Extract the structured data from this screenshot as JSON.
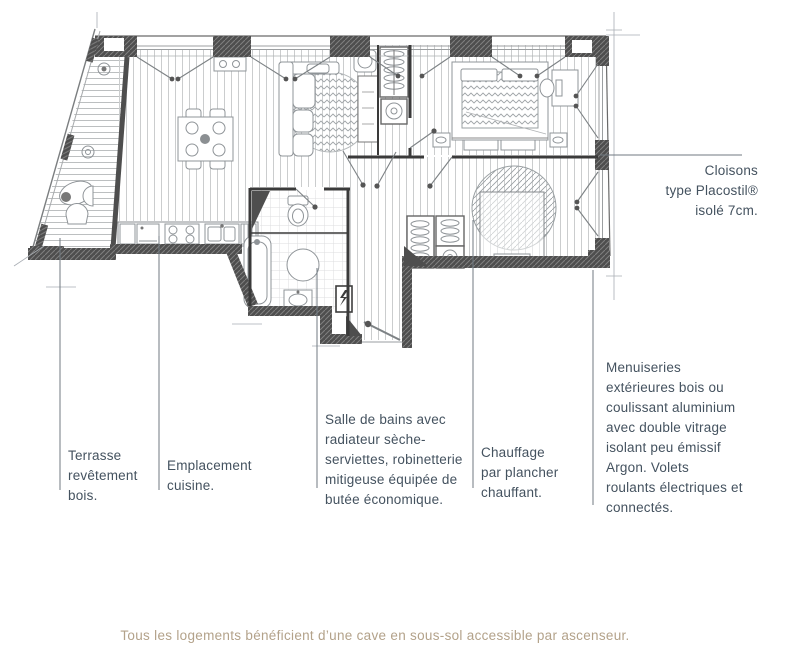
{
  "colors": {
    "annotation_text": "#44525f",
    "caption_text": "#b3a28a",
    "wall_dark": "#4e4e4e",
    "leader_line": "#707a82",
    "floor_line": "#c9cbcc"
  },
  "annotations": {
    "cloisons": {
      "lines": [
        "Cloisons",
        "type Placostil®",
        "isolé 7cm."
      ]
    },
    "menuiseries": {
      "lines": [
        "Menuiseries",
        "extérieures bois ou",
        "coulissant aluminium",
        "avec double vitrage",
        "isolant peu émissif",
        "Argon. Volets",
        "roulants électriques et",
        "connectés."
      ]
    },
    "terrasse": {
      "lines": [
        "Terrasse",
        "revêtement",
        "bois."
      ]
    },
    "cuisine": {
      "lines": [
        "Emplacement",
        "cuisine."
      ]
    },
    "salle_de_bains": {
      "lines": [
        "Salle de bains avec",
        "radiateur sèche-",
        "serviettes, robinetterie",
        "mitigeuse équipée de",
        "butée économique."
      ]
    },
    "chauffage": {
      "lines": [
        "Chauffage",
        "par plancher",
        "chauffant."
      ]
    }
  },
  "caption": {
    "text": "Tous les logements bénéficient d’une cave en sous-sol accessible par ascenseur."
  },
  "plan_symbols": [
    "terrace-deck",
    "terrace-chairs",
    "plant",
    "dining-table",
    "dining-chairs",
    "sideboard",
    "sofa",
    "round-rug",
    "kitchen-oven",
    "kitchen-hob",
    "kitchen-sink",
    "kitchen-radiator",
    "toilet",
    "bathtub",
    "shower-basin",
    "bathroom-sink",
    "electrical-panel",
    "washing-machine",
    "wardrobe-hangers",
    "bed-double",
    "nightstand",
    "desk",
    "bed-round-rug",
    "entry-door",
    "window-casement"
  ]
}
